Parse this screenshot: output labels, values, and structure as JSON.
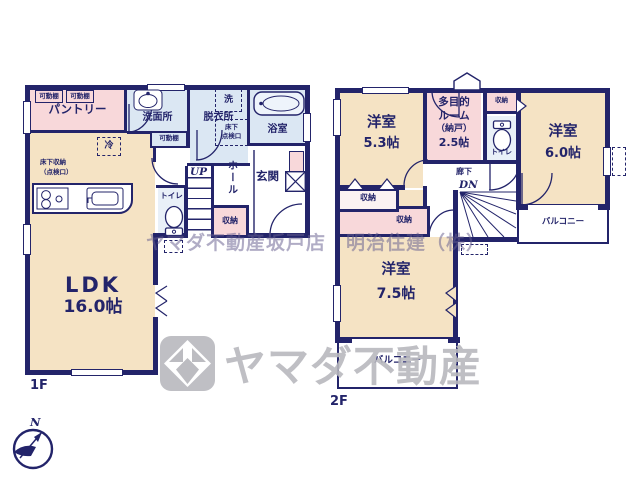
{
  "colors": {
    "wall": "#23246a",
    "room_beige": "#f5e3c4",
    "room_pink": "#f8d8da",
    "room_blue": "#dbe7f3",
    "room_pale": "#e9f0f8",
    "watermark_gray": "#b8b8be",
    "watermark_purple": "#685f90"
  },
  "floor1": {
    "label": "1F",
    "rooms": {
      "pantry": "パントリー",
      "washroom": "洗面所",
      "dressing": "脱衣所",
      "bath": "浴室",
      "hall": "ホール",
      "entrance": "玄関",
      "toilet": "トイレ",
      "storage": "収納",
      "ldk": "LDK",
      "ldk_size": "16.0帖",
      "stairs_up": "UP"
    },
    "fixtures": {
      "shelf": "可動棚",
      "fridge": "冷",
      "washer": "洗",
      "underfloor_1": "床下収納",
      "underfloor_2": "（点検口）",
      "hatch_1": "床下",
      "hatch_2": "点検口"
    }
  },
  "floor2": {
    "label": "2F",
    "rooms": {
      "west1": "洋室",
      "west1_size": "5.3帖",
      "multi_1": "多目的",
      "multi_2": "ルーム",
      "multi_3": "（納戸）",
      "multi_size": "2.5帖",
      "west2": "洋室",
      "west2_size": "6.0帖",
      "west3": "洋室",
      "west3_size": "7.5帖",
      "toilet": "トイレ",
      "corridor": "廊下",
      "stairs_down": "DN",
      "storage_top": "収納",
      "storage_a": "収納",
      "storage_b": "収納",
      "balcony_right": "バルコニー",
      "balcony_bottom": "バルコニー"
    }
  },
  "watermark": {
    "office_line": "ヤマダ不動産坂戸店　明治住建（株）",
    "brand": "ヤマダ不動産"
  },
  "compass": {
    "north": "N"
  }
}
